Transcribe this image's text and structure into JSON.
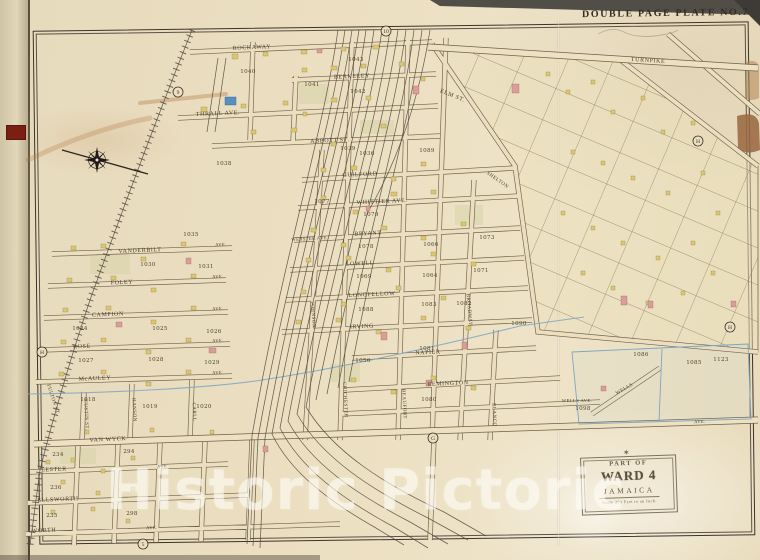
{
  "page": {
    "plate_title": "DOUBLE PAGE PLATE NO.7",
    "watermark": "Historic Pictoric"
  },
  "cartouche": {
    "part_of": "PART OF",
    "ward": "WARD 4",
    "place": "JAMAICA",
    "scale_note": "Scale 200 Feet to an Inch."
  },
  "map": {
    "ave": "AVE.",
    "streets": [
      "ROCKAWAY",
      "THRALL AVE.",
      "ABBOTT ST.",
      "GUILFORD",
      "WHITTIER AVE.",
      "BRYANT",
      "LOWELL",
      "LONGFELLOW",
      "IRVING",
      "NAPIER",
      "REMINGTON",
      "VAN WYCK",
      "McAULEY",
      "ROSE",
      "CAMPION",
      "FOLEY",
      "VANDERBILT",
      "LESTER",
      "ELLSWORTH",
      "WORTH",
      "BERKELEY",
      "TURNPIKE",
      "ELM ST.",
      "FULTON ST.",
      "JOHNSON",
      "CHICHESTER",
      "BEAUFORT",
      "BROADWAY",
      "BLANCO",
      "HANSON",
      "CARLL",
      "CUSTIN ST.",
      "WELLS",
      "WELLS AVE.",
      "WEBSTER AVE.",
      "SHELTON"
    ],
    "blocks": [
      "1040",
      "1043",
      "1041",
      "1042",
      "1039",
      "1036",
      "1038",
      "1077",
      "1079",
      "1078",
      "1066",
      "1073",
      "1071",
      "1064",
      "1069",
      "1089",
      "1088",
      "1083",
      "1056",
      "1081",
      "1080",
      "1082",
      "1090",
      "1030",
      "1031",
      "1024",
      "1025",
      "1026",
      "1027",
      "1028",
      "1029",
      "1018",
      "1019",
      "1020",
      "234",
      "294",
      "236",
      "235",
      "298",
      "1086",
      "1085",
      "1098",
      "1123",
      "1035"
    ],
    "refs": [
      "9",
      "10",
      "H",
      "H",
      "G",
      "5",
      "H"
    ]
  },
  "colors": {
    "paper": "#ecdfc1",
    "rail": "#4e463c",
    "water": "#7ea6c4",
    "building_yellow": "#dcc76e",
    "building_pink": "#d99e9b",
    "spine_label_red": "#7c1f13"
  }
}
